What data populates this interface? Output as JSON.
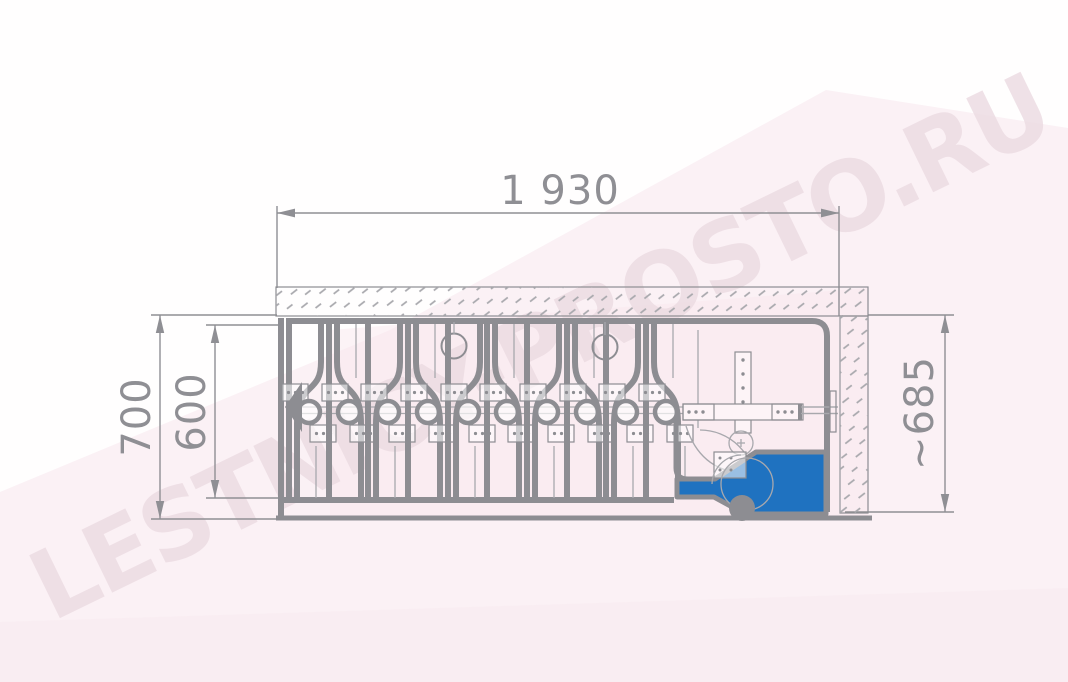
{
  "drawing": {
    "dimensions": {
      "length_label": "1 930",
      "outer_height_label": "700",
      "inner_height_label": "600",
      "approx_height_label": "~685"
    },
    "watermark_text": "LESTNICY-PROSTO.RU",
    "colors": {
      "line_gray": "#8d8d92",
      "thin_gray": "#a8a8ad",
      "dim_gray": "#8f8f94",
      "accent_blue": "#1f72c0",
      "background_pink": "#fbf1f5",
      "watermark_pink": "#ecdbe2"
    }
  }
}
